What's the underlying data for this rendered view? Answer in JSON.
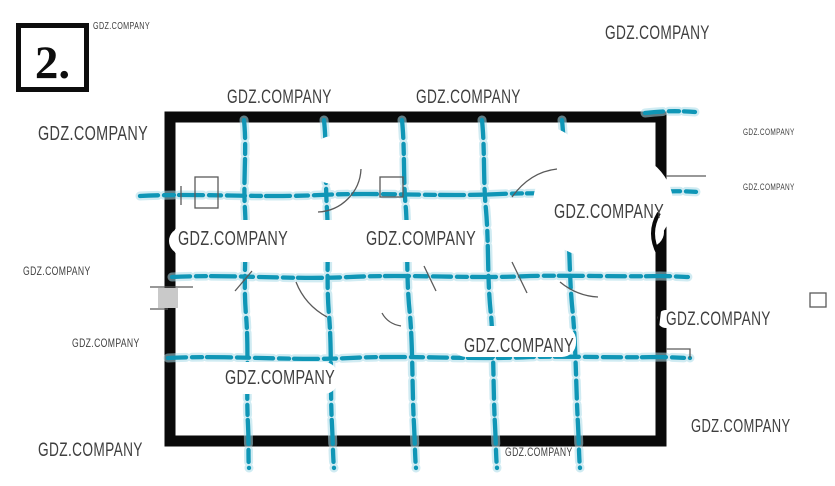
{
  "sheet": {
    "number": "2."
  },
  "watermark": {
    "text": "GDZ.COMPANY"
  },
  "drawing": {
    "type": "scanned-floor-plan-sketch",
    "colors": {
      "grid_blue": "#0f96b6",
      "grid_blue_halo": "#aadce9",
      "wall_black": "#0a0a0a",
      "detail_gray": "#5a5a5a",
      "paper_white": "#ffffff"
    }
  }
}
